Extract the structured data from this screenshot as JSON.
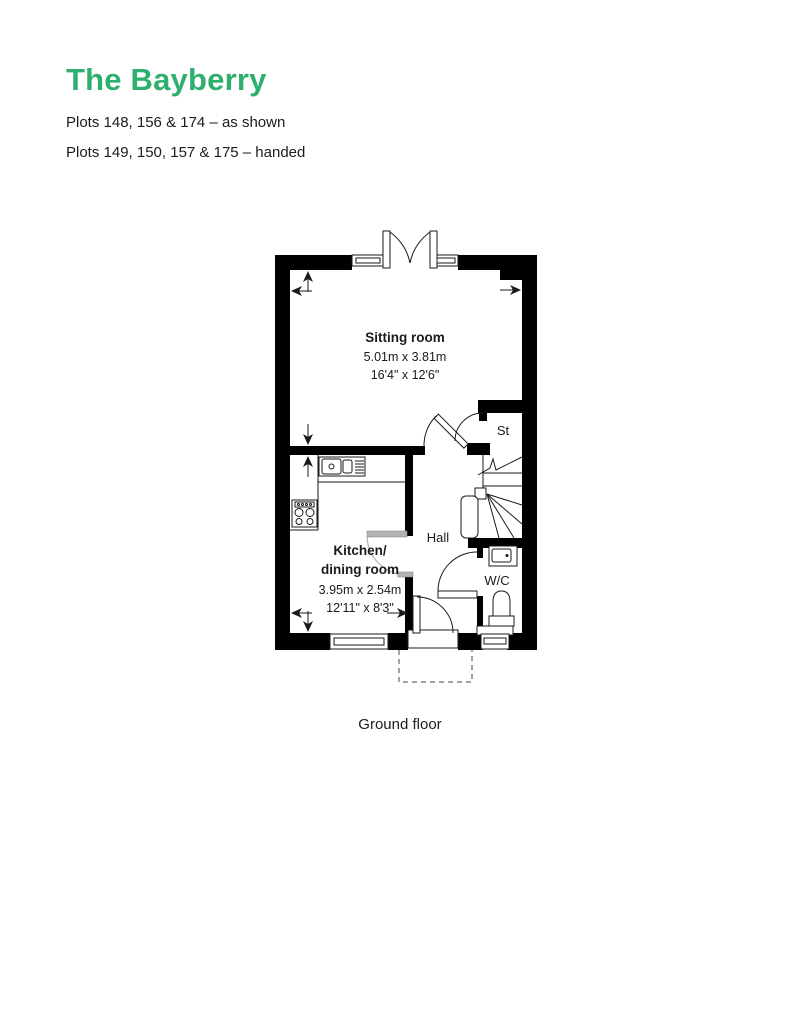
{
  "header": {
    "title": "The Bayberry",
    "plots_as_shown": "Plots 148, 156 & 174 – as shown",
    "plots_handed": "Plots 149, 150, 157 & 175 – handed"
  },
  "plan": {
    "sitting_room": {
      "name": "Sitting room",
      "metric": "5.01m x 3.81m",
      "imperial": "16'4\" x 12'6\""
    },
    "kitchen": {
      "name_line1": "Kitchen/",
      "name_line2": "dining room",
      "metric": "3.95m x 2.54m",
      "imperial": "12'11\" x 8'3\""
    },
    "hall": "Hall",
    "store": "St",
    "wc": "W/C"
  },
  "caption": "Ground floor",
  "colors": {
    "accent_green": "#2faf6e",
    "wall_black": "#000000",
    "text": "#1b1b1b",
    "door_gray": "#b3b3b3"
  }
}
